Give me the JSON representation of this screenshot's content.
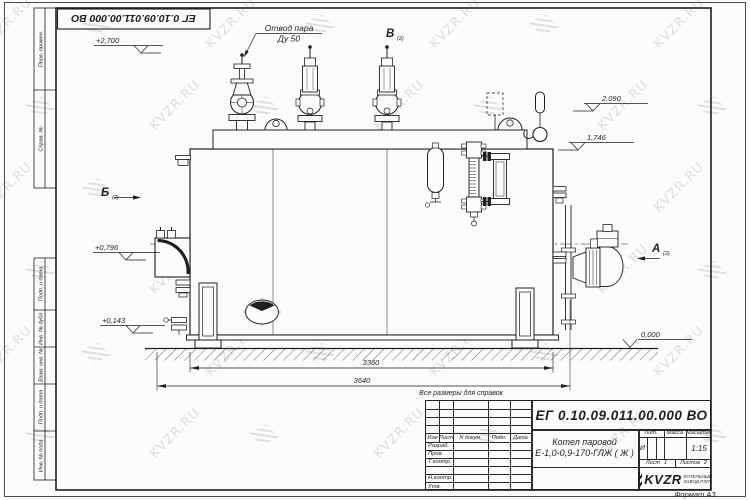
{
  "page": {
    "note_for_reference": "Все размеры для справок",
    "format_label": "Формат А3",
    "watermark_text": "KVZR.RU"
  },
  "top_stamp": {
    "doc_number": "ЕГ 0.10.09.011.00.000  ВО"
  },
  "margin_columns": {
    "top": [
      "Перв. примен.",
      "Справ. №"
    ],
    "bottom": [
      "Подп. и дата",
      "Инв. № дубл.",
      "Взам. инв. №",
      "Подп. и дата",
      "Инв. № подл."
    ]
  },
  "drawing": {
    "callout": {
      "line1": "Отвод пара",
      "line2": "Ду 50"
    },
    "views": [
      {
        "label": "Б",
        "sheet": "(2)"
      },
      {
        "label": "В",
        "sheet": "(2)"
      },
      {
        "label": "А",
        "sheet": "(2)"
      }
    ],
    "elevations": [
      {
        "value": "+2,700"
      },
      {
        "value": "2,090"
      },
      {
        "value": "1,746"
      },
      {
        "value": "+0,796"
      },
      {
        "value": "+0,143"
      },
      {
        "value": "0,000"
      }
    ],
    "dimensions": [
      {
        "value": "3360"
      },
      {
        "value": "3640"
      }
    ]
  },
  "title_block": {
    "doc_number": "ЕГ 0.10.09.011.00.000  ВО",
    "product_line1": "Котел паровой",
    "product_line2": "Е-1,0-0,9-170-ГЛЖ ( Ж )",
    "change_headers": [
      "Изм",
      "Лист",
      "N докум.",
      "Подп.",
      "Дата"
    ],
    "roles": [
      "Разраб.",
      "Пров.",
      "Т.контр.",
      "Н.контр.",
      "Утв."
    ],
    "lit_header": "Лит.",
    "mass_header": "Масса",
    "scale_header": "Масштаб",
    "lit_value": "И",
    "scale_value": "1:15",
    "sheet_label": "Лист",
    "sheet_value": "1",
    "sheets_label": "Листов",
    "sheets_value": "2",
    "logo_text": "KVZR",
    "logo_caption_line1": "КОТЕЛЬНЫЙ",
    "logo_caption_line2": "ЗАВОД РЭП"
  }
}
